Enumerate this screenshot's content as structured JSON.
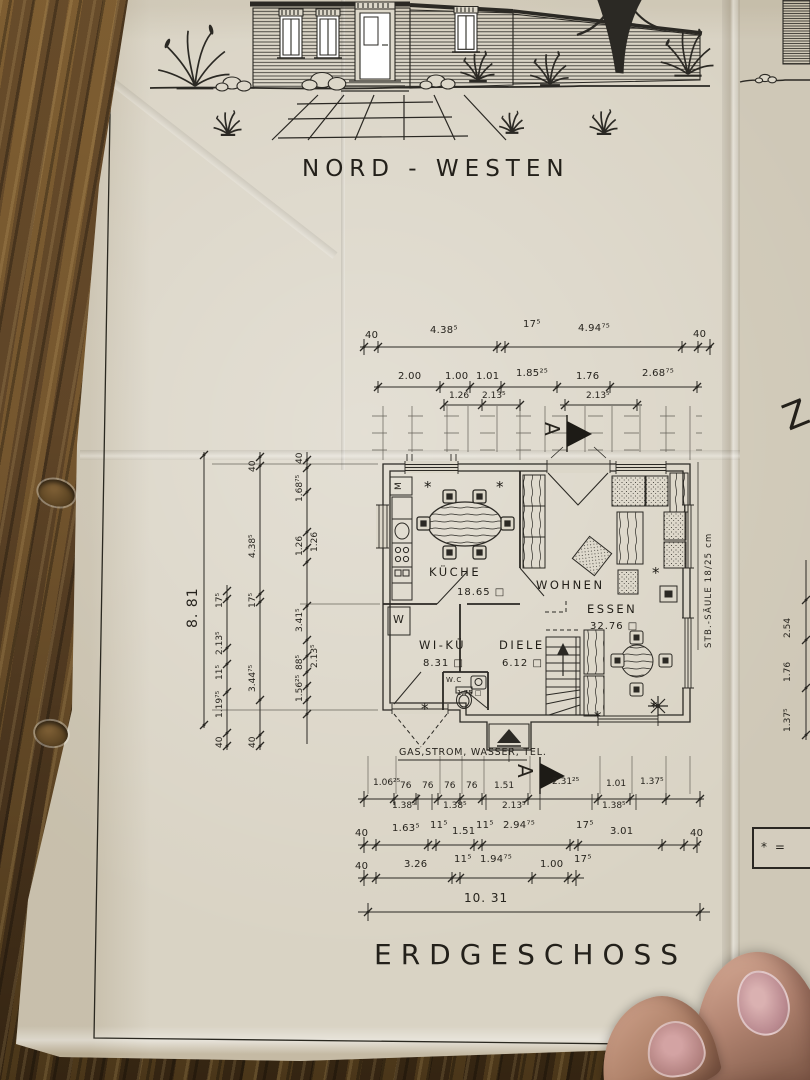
{
  "titles": {
    "elevation": "NORD - WESTEN",
    "floor": "ERDGESCHOSS"
  },
  "plan": {
    "rooms": [
      {
        "name": "KÜCHE",
        "area": "18.65 □"
      },
      {
        "name": "WOHNEN",
        "area": ""
      },
      {
        "name": "ESSEN",
        "area": "32.76 □"
      },
      {
        "name": "WI-KÜ",
        "area": "8.31 □"
      },
      {
        "name": "DIELE",
        "area": "6.12 □"
      },
      {
        "name": "W.C",
        "area": "1.75 □"
      }
    ],
    "fixtures": {
      "m": "M",
      "w": "W"
    },
    "column_symbol": "*",
    "column_note": "STB.-SÄULE 18/25 cm",
    "utilities": "GAS,STROM, WASSER, TEL.",
    "section_letter": "A",
    "legend_prefix": "* =",
    "edge_letter": "Z"
  },
  "dims": {
    "overall_w": "10. 31",
    "overall_h": "8. 81",
    "top1": [
      "40",
      "4.38⁵",
      "17⁵",
      "4.94⁷⁵",
      "40"
    ],
    "top2": [
      "2.00",
      "1.00",
      "1.01",
      "1.85²⁵",
      "1.76",
      "2.68⁷⁵"
    ],
    "top3": [
      "1.26",
      "2.13⁵",
      "2.13⁵"
    ],
    "left_outer": [
      "40",
      "1.19⁷⁵",
      "11⁵",
      "2.13⁵",
      "17⁵"
    ],
    "left_mid": [
      "40",
      "3.44⁷⁵",
      "17⁵",
      "4.38⁵",
      "40"
    ],
    "left_inner": [
      "1.56²⁵",
      "88⁵",
      "2.13⁵",
      "3.41⁵",
      "1.26",
      "1.26",
      "1.68⁷⁵",
      "40"
    ],
    "bottom1": [
      "1.06²⁵",
      "76",
      "76",
      "76",
      "76",
      "1.51",
      "2.31²⁵",
      "1.01",
      "1.37⁵"
    ],
    "bottom1b": [
      "1.38⁵",
      "1.38⁵",
      "2.13⁵",
      "1.38⁵"
    ],
    "bottom2": [
      "40",
      "1.63⁵",
      "11⁵",
      "1.51",
      "11⁵",
      "2.94⁷⁵",
      "17⁵",
      "3.01",
      "40"
    ],
    "bottom3": [
      "40",
      "3.26",
      "11⁵",
      "1.94⁷⁵",
      "1.00",
      "17⁵"
    ],
    "right": [
      "2.54",
      "1.76",
      "1.37⁵"
    ]
  }
}
